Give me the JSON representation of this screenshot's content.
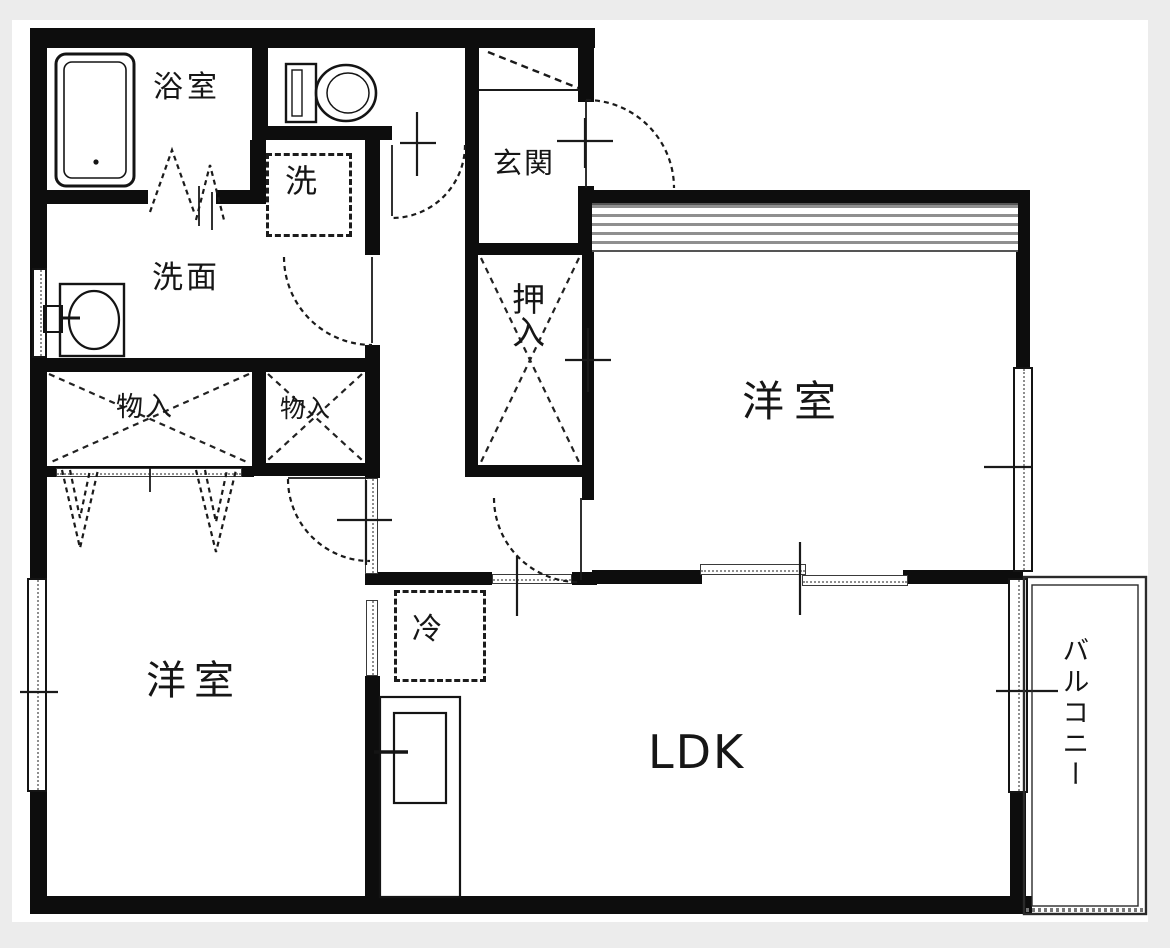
{
  "plan": {
    "type": "apartment-floor-plan",
    "rooms": {
      "bathroom": {
        "label": "浴室"
      },
      "washer": {
        "label": "洗"
      },
      "washroom": {
        "label": "洗面"
      },
      "entrance": {
        "label": "玄関"
      },
      "futon_closet": {
        "label": "押入"
      },
      "storage_left": {
        "label": "物入"
      },
      "storage_right": {
        "label": "物入"
      },
      "western_room_upper": {
        "label": "洋室"
      },
      "western_room_lower": {
        "label": "洋室"
      },
      "living": {
        "label": "LDK"
      },
      "refrigerator": {
        "label": "冷"
      },
      "balcony": {
        "label": "バルコニー"
      }
    },
    "colors": {
      "wall": "#0d0d0d",
      "floor": "#ffffff",
      "page_background": "#ececec",
      "hatch_gray": "#8f8f8f",
      "line": "#1a1a1a"
    }
  }
}
